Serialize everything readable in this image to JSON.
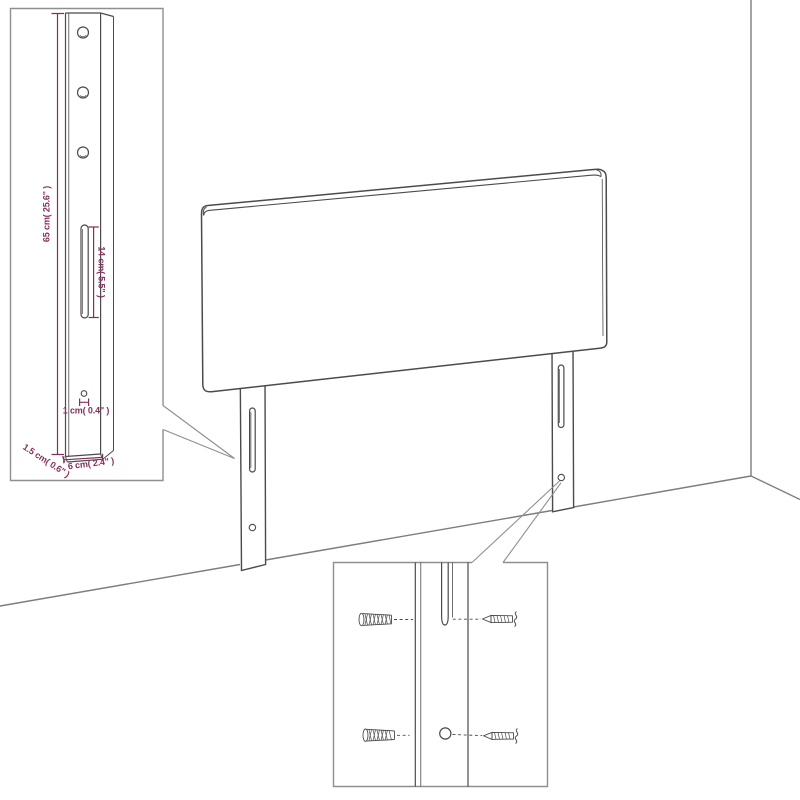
{
  "labels": {
    "height": "65 cm( 25.6\" )",
    "slot_height": "14 cm( 5.5\" )",
    "hole": "1 cm( 0.4\" )",
    "thickness": "1.5 cm( 0.6\" )",
    "leg_width": "6 cm( 2.4\" )"
  },
  "colors": {
    "dimension": "#84305f",
    "artline": "#4b4b4b",
    "box_border": "#8f8f8f",
    "wall_line": "#7d7d7d"
  }
}
